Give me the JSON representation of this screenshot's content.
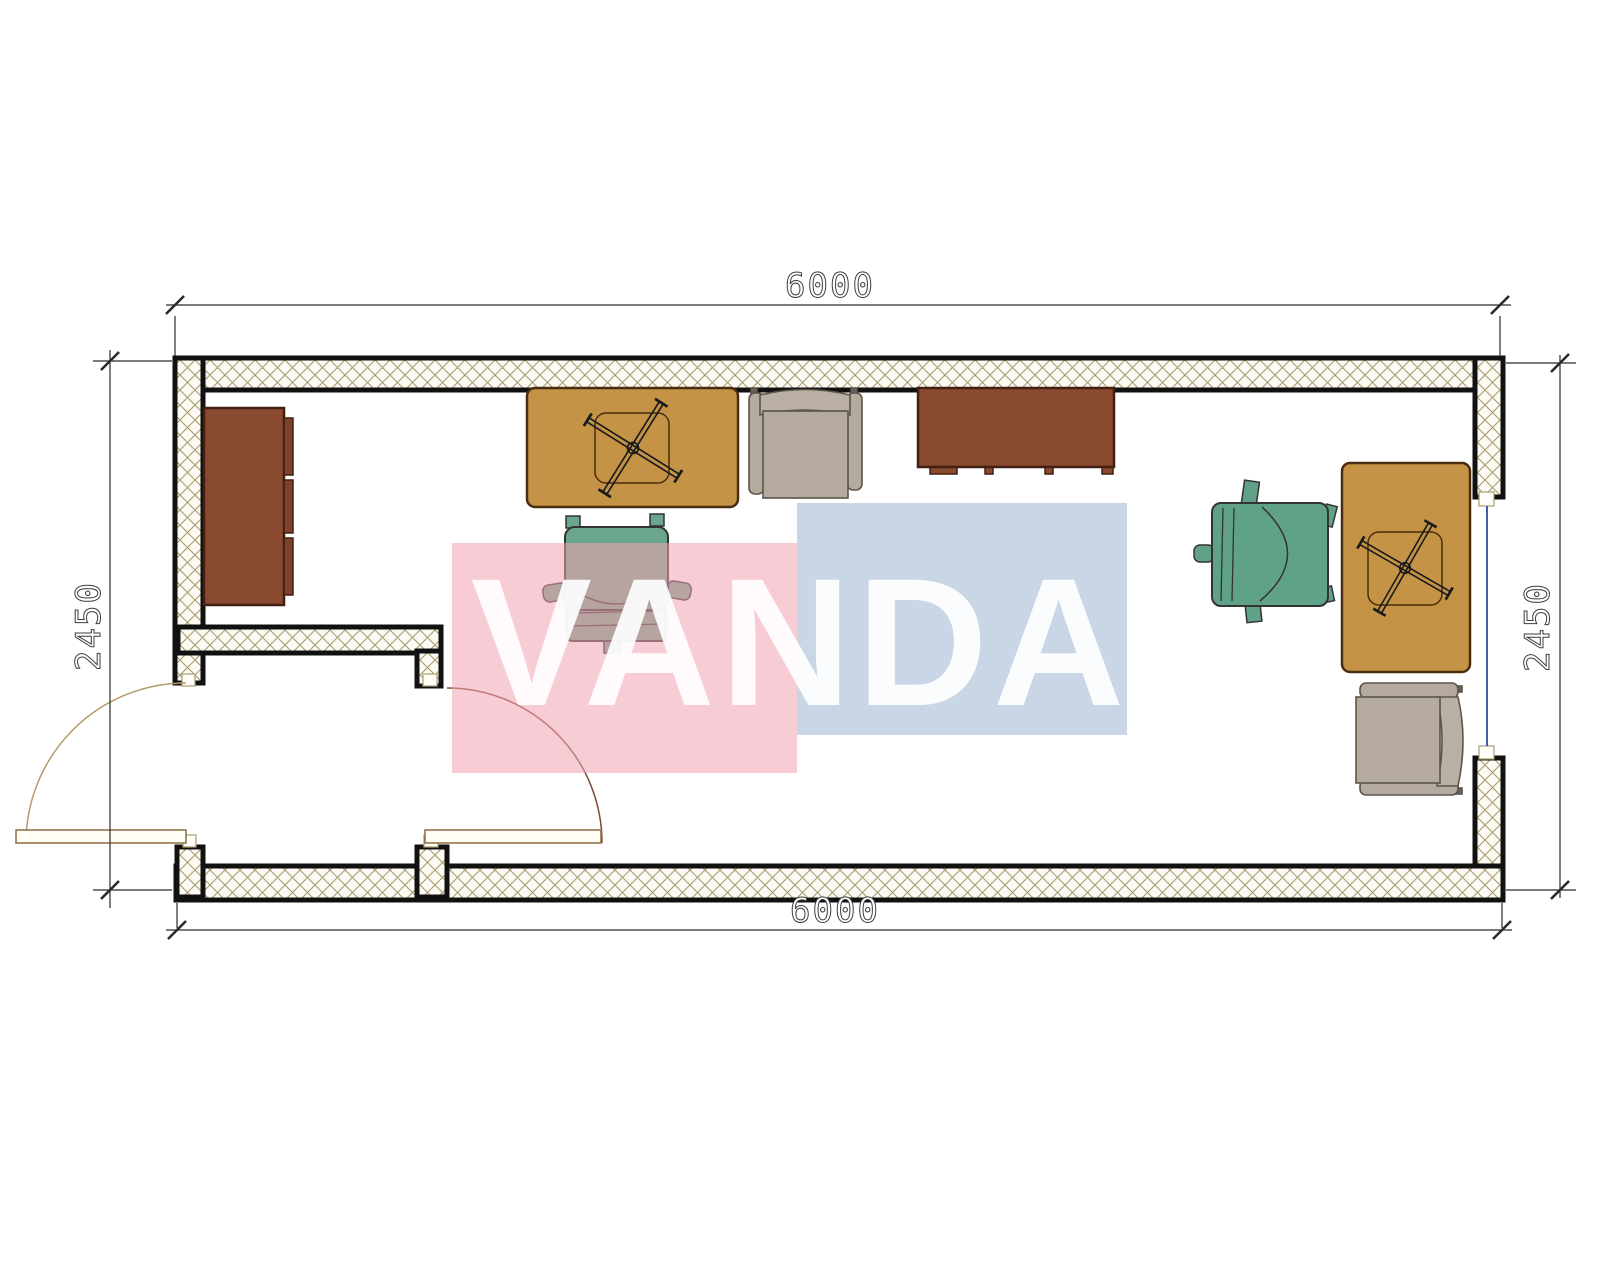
{
  "drawing": {
    "watermark_text": "VANDA",
    "dim_top": "6000",
    "dim_bottom": "6000",
    "dim_left": "2450",
    "dim_right": "2450"
  },
  "colors": {
    "wall_hatch_line": "#a89d72",
    "wall_outline": "#111111",
    "wood_brown": "#8a4a30",
    "desk_yellow": "#c49345",
    "chair_green": "#5fa287",
    "armchair_beige": "#b4aa9d",
    "window_glass_blue": "#3f5fae",
    "door_arc_tan": "#b59a6a",
    "watermark_pink": "#f4a9b6",
    "watermark_blue": "#bccde3"
  },
  "plan_elements": [
    {
      "name": "exterior-walls",
      "type": "hatched-wall"
    },
    {
      "name": "vestibule-partition",
      "type": "hatched-wall"
    },
    {
      "name": "entry-door",
      "type": "door",
      "swing": "outward-left"
    },
    {
      "name": "vestibule-door",
      "type": "door",
      "swing": "into-room"
    },
    {
      "name": "window-right-wall",
      "type": "window"
    },
    {
      "name": "cabinet-left",
      "color": "#8a4a30"
    },
    {
      "name": "sideboard-top",
      "color": "#8a4a30"
    },
    {
      "name": "desk-center",
      "color": "#c49345"
    },
    {
      "name": "desk-right",
      "color": "#c49345"
    },
    {
      "name": "office-chair-center",
      "color": "#5fa287"
    },
    {
      "name": "office-chair-right",
      "color": "#5fa287"
    },
    {
      "name": "armchair-top",
      "color": "#b4aa9d"
    },
    {
      "name": "armchair-bottom-right",
      "color": "#b4aa9d"
    }
  ]
}
